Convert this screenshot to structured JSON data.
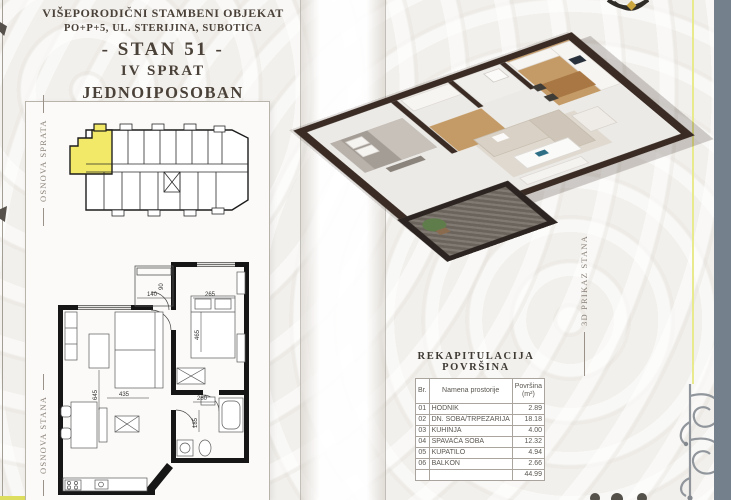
{
  "header": {
    "line1": "VIŠEPORODIČNI STAMBENI OBJEKAT",
    "line2": "PO+P+5, UL. STERIJINA, SUBOTICA",
    "line3": "- STAN 51 -",
    "line4": "IV SPRAT",
    "line5": "JEDNOIPOSOBAN"
  },
  "side_labels": {
    "left_top": "OSNOVA SPRATA",
    "left_bottom": "OSNOVA STANA",
    "right": "3D PRIKAZ STANA"
  },
  "unit_plan_dims": [
    "140",
    "90",
    "265",
    "465",
    "645",
    "435",
    "280",
    "185"
  ],
  "area_table": {
    "title": "REKAPITULACIJA POVRŠINA",
    "columns": {
      "num": "Br.",
      "name": "Namena prostorije",
      "area_line1": "Površina",
      "area_line2": "(m²)"
    },
    "rows": [
      {
        "br": "01",
        "name": "HODNIK",
        "area": "2.89"
      },
      {
        "br": "02",
        "name": "DN. SOBA/TRPEZARIJA",
        "area": "18.18"
      },
      {
        "br": "03",
        "name": "KUHINJA",
        "area": "4.00"
      },
      {
        "br": "04",
        "name": "SPAVAĆA SOBA",
        "area": "12.32"
      },
      {
        "br": "05",
        "name": "KUPATILO",
        "area": "4.94"
      },
      {
        "br": "06",
        "name": "BALKON",
        "area": "2.66"
      }
    ],
    "total_area": "44.99"
  },
  "colors": {
    "unit_highlight": "#f2e968",
    "accent_yellow": "#e9e98d",
    "right_strip": "#74818d",
    "plan_wall": "#161616",
    "render_wall": "#3a2c24"
  }
}
